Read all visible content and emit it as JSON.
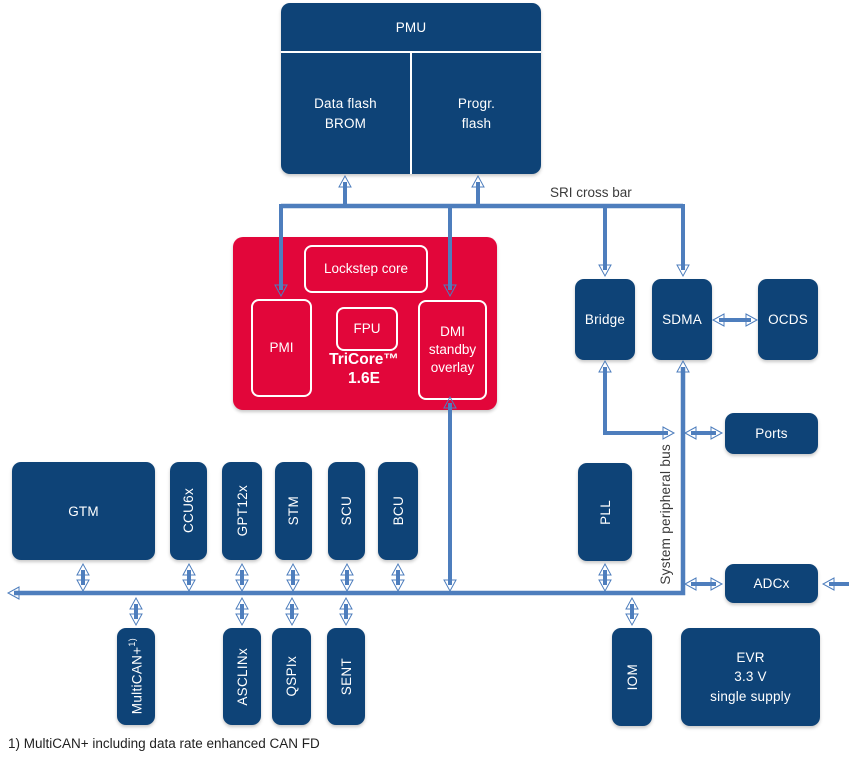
{
  "diagram": {
    "pmu": {
      "title": "PMU",
      "left_cell": "Data flash\nBROM",
      "right_cell": "Progr.\nflash"
    },
    "sri_bus_label": "SRI cross bar",
    "tricore": {
      "title": "TriCore™\n1.6E",
      "lockstep": "Lockstep core",
      "pmi": "PMI",
      "fpu": "FPU",
      "dmi": "DMI\nstandby\noverlay"
    },
    "right_column": {
      "bridge": "Bridge",
      "sdma": "SDMA",
      "ocds": "OCDS",
      "ports": "Ports"
    },
    "peripheral_bus_label": "System peripheral bus",
    "row_upper": {
      "gtm": "GTM",
      "ccu6": "CCU6x",
      "gpt12": "GPT12x",
      "stm": "STM",
      "scu": "SCU",
      "bcu": "BCU",
      "pll": "PLL",
      "adc": "ADCx"
    },
    "row_lower": {
      "multican": {
        "label": "MultiCAN+",
        "sup": "1)"
      },
      "asclin": "ASCLINx",
      "qspi": "QSPIx",
      "sent": "SENT",
      "iom": "IOM",
      "evr": "EVR\n3.3 V\nsingle supply"
    },
    "footnote": "1) MultiCAN+ including data rate enhanced CAN FD",
    "colors": {
      "block_navy": "#0E4377",
      "core_red": "#E2063A",
      "arrow_blue": "#4E7EBD"
    }
  }
}
